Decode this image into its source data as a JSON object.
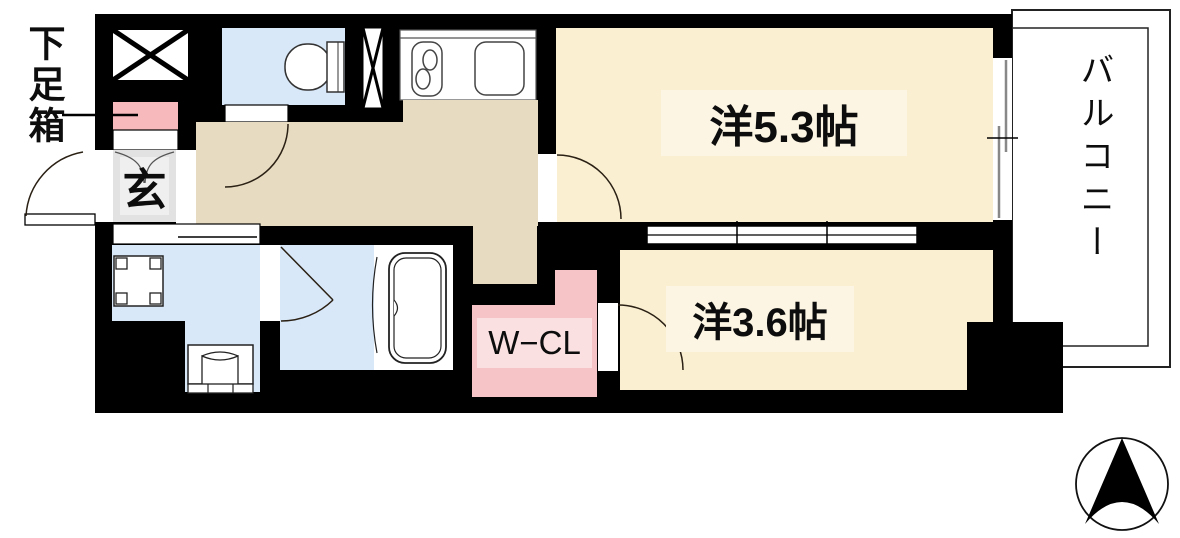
{
  "floorplan": {
    "rooms": {
      "western_room_5_3": {
        "label": "洋5.3帖"
      },
      "western_room_3_6": {
        "label": "洋3.6帖"
      },
      "walk_in_closet": {
        "label": "W−CL"
      },
      "balcony": {
        "label": "バルコニー"
      },
      "entrance": {
        "label": "玄"
      },
      "shoe_box": {
        "label": "下足箱"
      }
    },
    "icons": {
      "compass": "north-compass-icon",
      "toilet": "toilet-icon",
      "stove": "stove-burner-icon",
      "sink": "kitchen-sink-icon",
      "bathtub": "bathtub-icon",
      "washing_machine_pan": "washing-machine-pan-icon",
      "washbasin": "washbasin-icon",
      "pipe_shaft": "shaft-x-icon",
      "elevator_shaft": "shaft-x-box-icon"
    },
    "colors": {
      "wall": "#000000",
      "room_floor": "#faefd1",
      "hallway_floor": "#e7dbc1",
      "wet_area_floor": "#d9e8f8",
      "closet_pink": "#f6c4c7",
      "closet_label_band": "#fbe0e1",
      "shoe_box_pink": "#f8b9bd",
      "entrance_gray": "#e2e2e2",
      "entrance_inner_gray": "#efefef",
      "balcony_line": "#222222"
    }
  }
}
